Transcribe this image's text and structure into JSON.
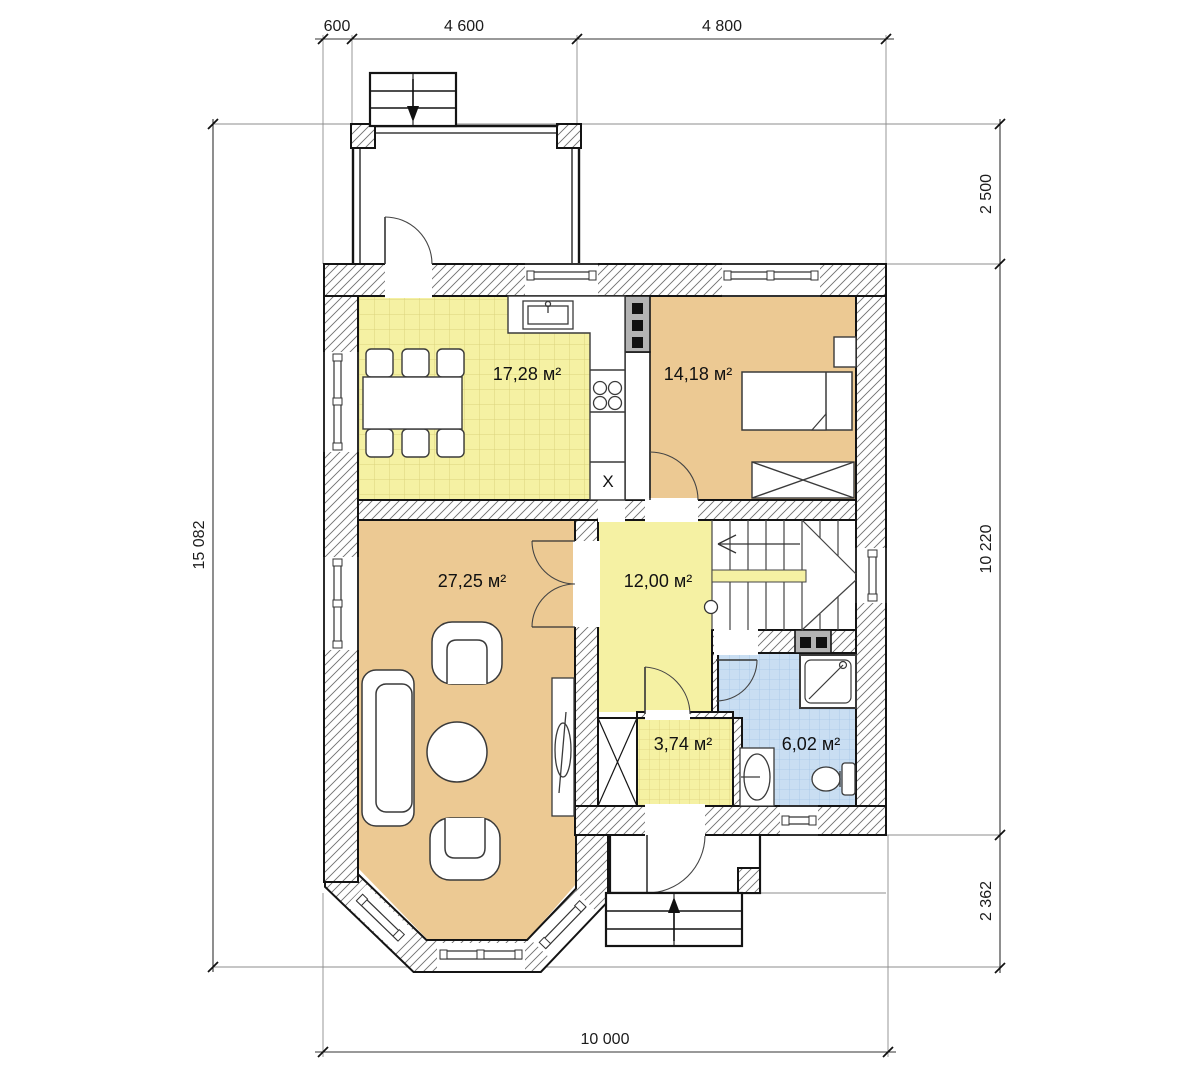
{
  "drawing": {
    "type": "floor-plan",
    "dimensions": {
      "top": [
        "600",
        "4 600",
        "4 800"
      ],
      "right": [
        "2 500",
        "10 220",
        "2 362"
      ],
      "left": [
        "15 082"
      ],
      "bottom": [
        "10 000"
      ]
    },
    "rooms": [
      {
        "id": "kitchen",
        "area": "17,28 м²"
      },
      {
        "id": "bedroom",
        "area": "14,18 м²"
      },
      {
        "id": "living",
        "area": "27,25 м²"
      },
      {
        "id": "hall",
        "area": "12,00 м²"
      },
      {
        "id": "vestibule",
        "area": "3,74 м²"
      },
      {
        "id": "bathroom",
        "area": "6,02 м²"
      }
    ],
    "appliance_label": "X",
    "colors": {
      "room_tan": "#ecc993",
      "room_yellow": "#f5f1a3",
      "room_blue": "#c9def2",
      "chimney_gray": "#b3b3b3",
      "wall_stroke": "#141414"
    },
    "icons": [
      "stairs-up-arrow-icon",
      "stairs-down-arrow-icon",
      "staircase-direction-arrow-icon"
    ]
  }
}
